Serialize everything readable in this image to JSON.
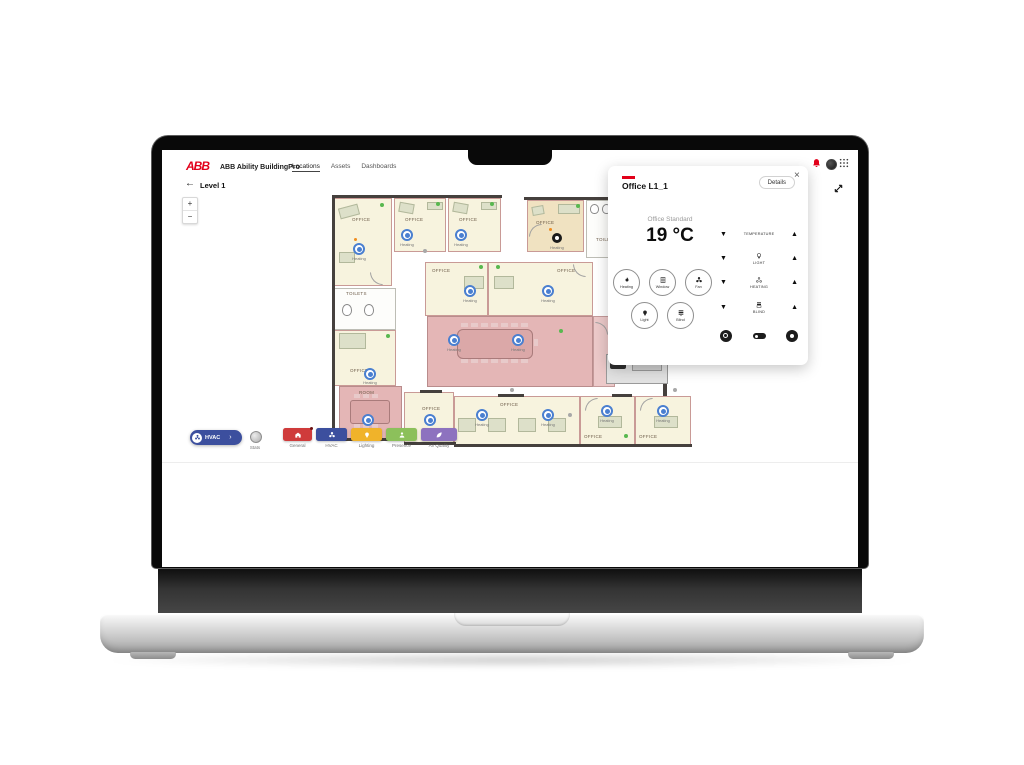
{
  "colors": {
    "brand_red": "#e2001a",
    "hvac_blue": "#3c4f9e",
    "general_red": "#cf3b3b",
    "lighting_yellow": "#f0b32a",
    "presence_green": "#8cc05b",
    "air_quality_purple": "#8d72bf",
    "sensor_blue": "#4a7fd0",
    "selected_room_tan": "#f0e2c1",
    "meeting_pink": "#e4b6b6"
  },
  "header": {
    "logo": "ABB",
    "title": "ABB Ability BuildingPro",
    "nav": [
      {
        "label": "Locations",
        "active": true
      },
      {
        "label": "Assets",
        "active": false
      },
      {
        "label": "Dashboards",
        "active": false
      }
    ]
  },
  "level_bar": {
    "back_icon": "←",
    "label": "Level 1"
  },
  "zoom_controls": {
    "zoom_in": "+",
    "zoom_out": "−"
  },
  "floorplan": {
    "sensor_label": "Heating",
    "labels": {
      "office": "OFFICE",
      "toilets": "TOILETS",
      "room": "ROOM"
    }
  },
  "toolbar": {
    "hvac_pill": {
      "label": "HVAC",
      "chevron": "›"
    },
    "stats": {
      "label": "Stats"
    },
    "filters": [
      {
        "label": "General"
      },
      {
        "label": "HVAC"
      },
      {
        "label": "Lighting"
      },
      {
        "label": "Presence"
      },
      {
        "label": "Air Quality"
      }
    ]
  },
  "popup": {
    "title": "Office L1_1",
    "details_button": "Details",
    "close_icon": "×",
    "mode_label": "Office Standard",
    "temperature": "19 °C",
    "gauges": [
      {
        "label": "Heating"
      },
      {
        "label": "Window"
      },
      {
        "label": "Fan"
      },
      {
        "label": "Light"
      },
      {
        "label": "Blind"
      }
    ],
    "controls": [
      {
        "label": "TEMPERATURE"
      },
      {
        "label": "LIGHT"
      },
      {
        "label": "HEATING"
      },
      {
        "label": "BLIND"
      }
    ],
    "decrease_icon": "▼",
    "increase_icon": "▲"
  }
}
